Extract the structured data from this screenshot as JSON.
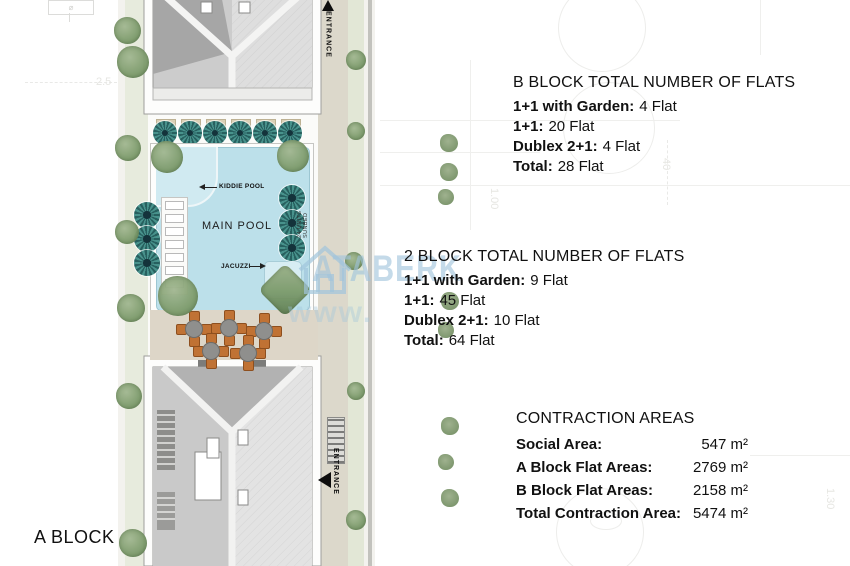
{
  "plan": {
    "a_block_label": "A BLOCK",
    "entrance_top": "ENTRANCE",
    "entrance_bottom": "ENTRANCE",
    "labels": {
      "kiddie_pool": "KIDDIE POOL",
      "main_pool": "MAIN POOL",
      "jacuzzi": "JACUZZI",
      "sunbeds": "24 UNITS SUNBED"
    }
  },
  "info_blocks": {
    "b_block": {
      "title": "B BLOCK TOTAL NUMBER OF FLATS",
      "rows": [
        {
          "label": "1+1 with Garden:",
          "value": "4 Flat"
        },
        {
          "label": "1+1:",
          "value": "20 Flat"
        },
        {
          "label": "Dublex 2+1:",
          "value": "4 Flat"
        },
        {
          "label": "Total:",
          "value": "28 Flat"
        }
      ]
    },
    "block2": {
      "title": "2 BLOCK TOTAL NUMBER OF FLATS",
      "rows": [
        {
          "label": "1+1 with Garden:",
          "value": "9 Flat"
        },
        {
          "label": "1+1:",
          "value": "45 Flat"
        },
        {
          "label": "Dublex 2+1:",
          "value": "10 Flat"
        },
        {
          "label": "Total:",
          "value": "64 Flat"
        }
      ]
    },
    "contraction": {
      "title": "CONTRACTION AREAS",
      "rows": [
        {
          "label": "Social Area:",
          "value": "547 m²"
        },
        {
          "label": "A Block Flat Areas:",
          "value": "2769 m²"
        },
        {
          "label": "B Block Flat Areas:",
          "value": "2158 m²"
        },
        {
          "label": "Total Contraction Area:",
          "value": "5474 m²"
        }
      ]
    }
  },
  "watermark": {
    "text": "ATABERK",
    "sub": "www.",
    "color": "#a0c4db"
  },
  "background": {
    "survey_marks": [
      {
        "text": "2.5"
      },
      {
        "text": "1.00"
      },
      {
        "text": "40"
      },
      {
        "text": "1.30"
      }
    ]
  },
  "colors": {
    "pool_water": "#bce0ea",
    "parasol_teal": "#48928c",
    "tree_green": "#7e9c6d",
    "chair_orange": "#c07234",
    "roof_dark": "#a6a6a6",
    "roof_light": "#dedede",
    "path_beige": "#dcd8cb"
  }
}
